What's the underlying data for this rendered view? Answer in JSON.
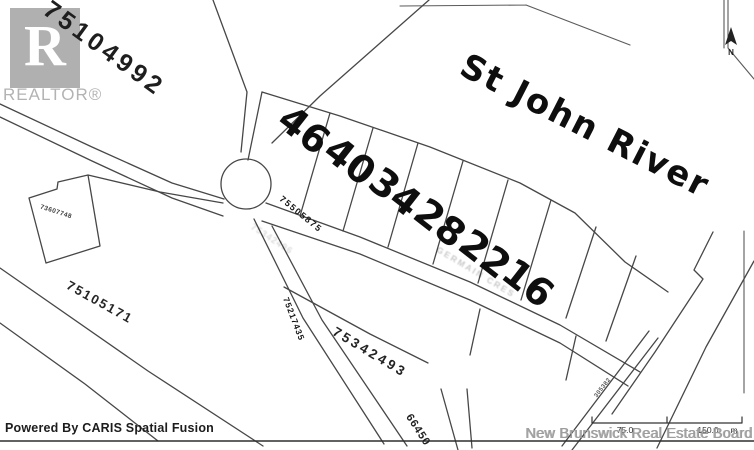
{
  "branding": {
    "realtor_logo_letter": "R",
    "realtor_wordmark": "REALTOR®",
    "board_watermark": "New Brunswick Real Estate Board",
    "powered_by": "Powered By CARIS Spatial Fusion"
  },
  "map": {
    "river_label": "St John River",
    "north_label": "N",
    "lots": [
      "46",
      "40",
      "34",
      "28",
      "22",
      "16"
    ],
    "parcels": {
      "upper_left": "75104992",
      "small_box": "73607748",
      "lower_left": "75105171",
      "road_pid": "75505875",
      "steep_road_pid": "75217435",
      "mid_pid": "75342493",
      "bottom_pid": "66450",
      "strip_pid": "305382",
      "faint_pid": "75342496"
    },
    "street_label_faint": "GERMAIN CRES",
    "scale_bar": {
      "mid": "75.0",
      "end": "150.0",
      "unit": "m"
    }
  },
  "colors": {
    "line": "#474747",
    "ink": "#161616",
    "watermark_gray": "#b0b0b0",
    "paper": "#ffffff"
  }
}
